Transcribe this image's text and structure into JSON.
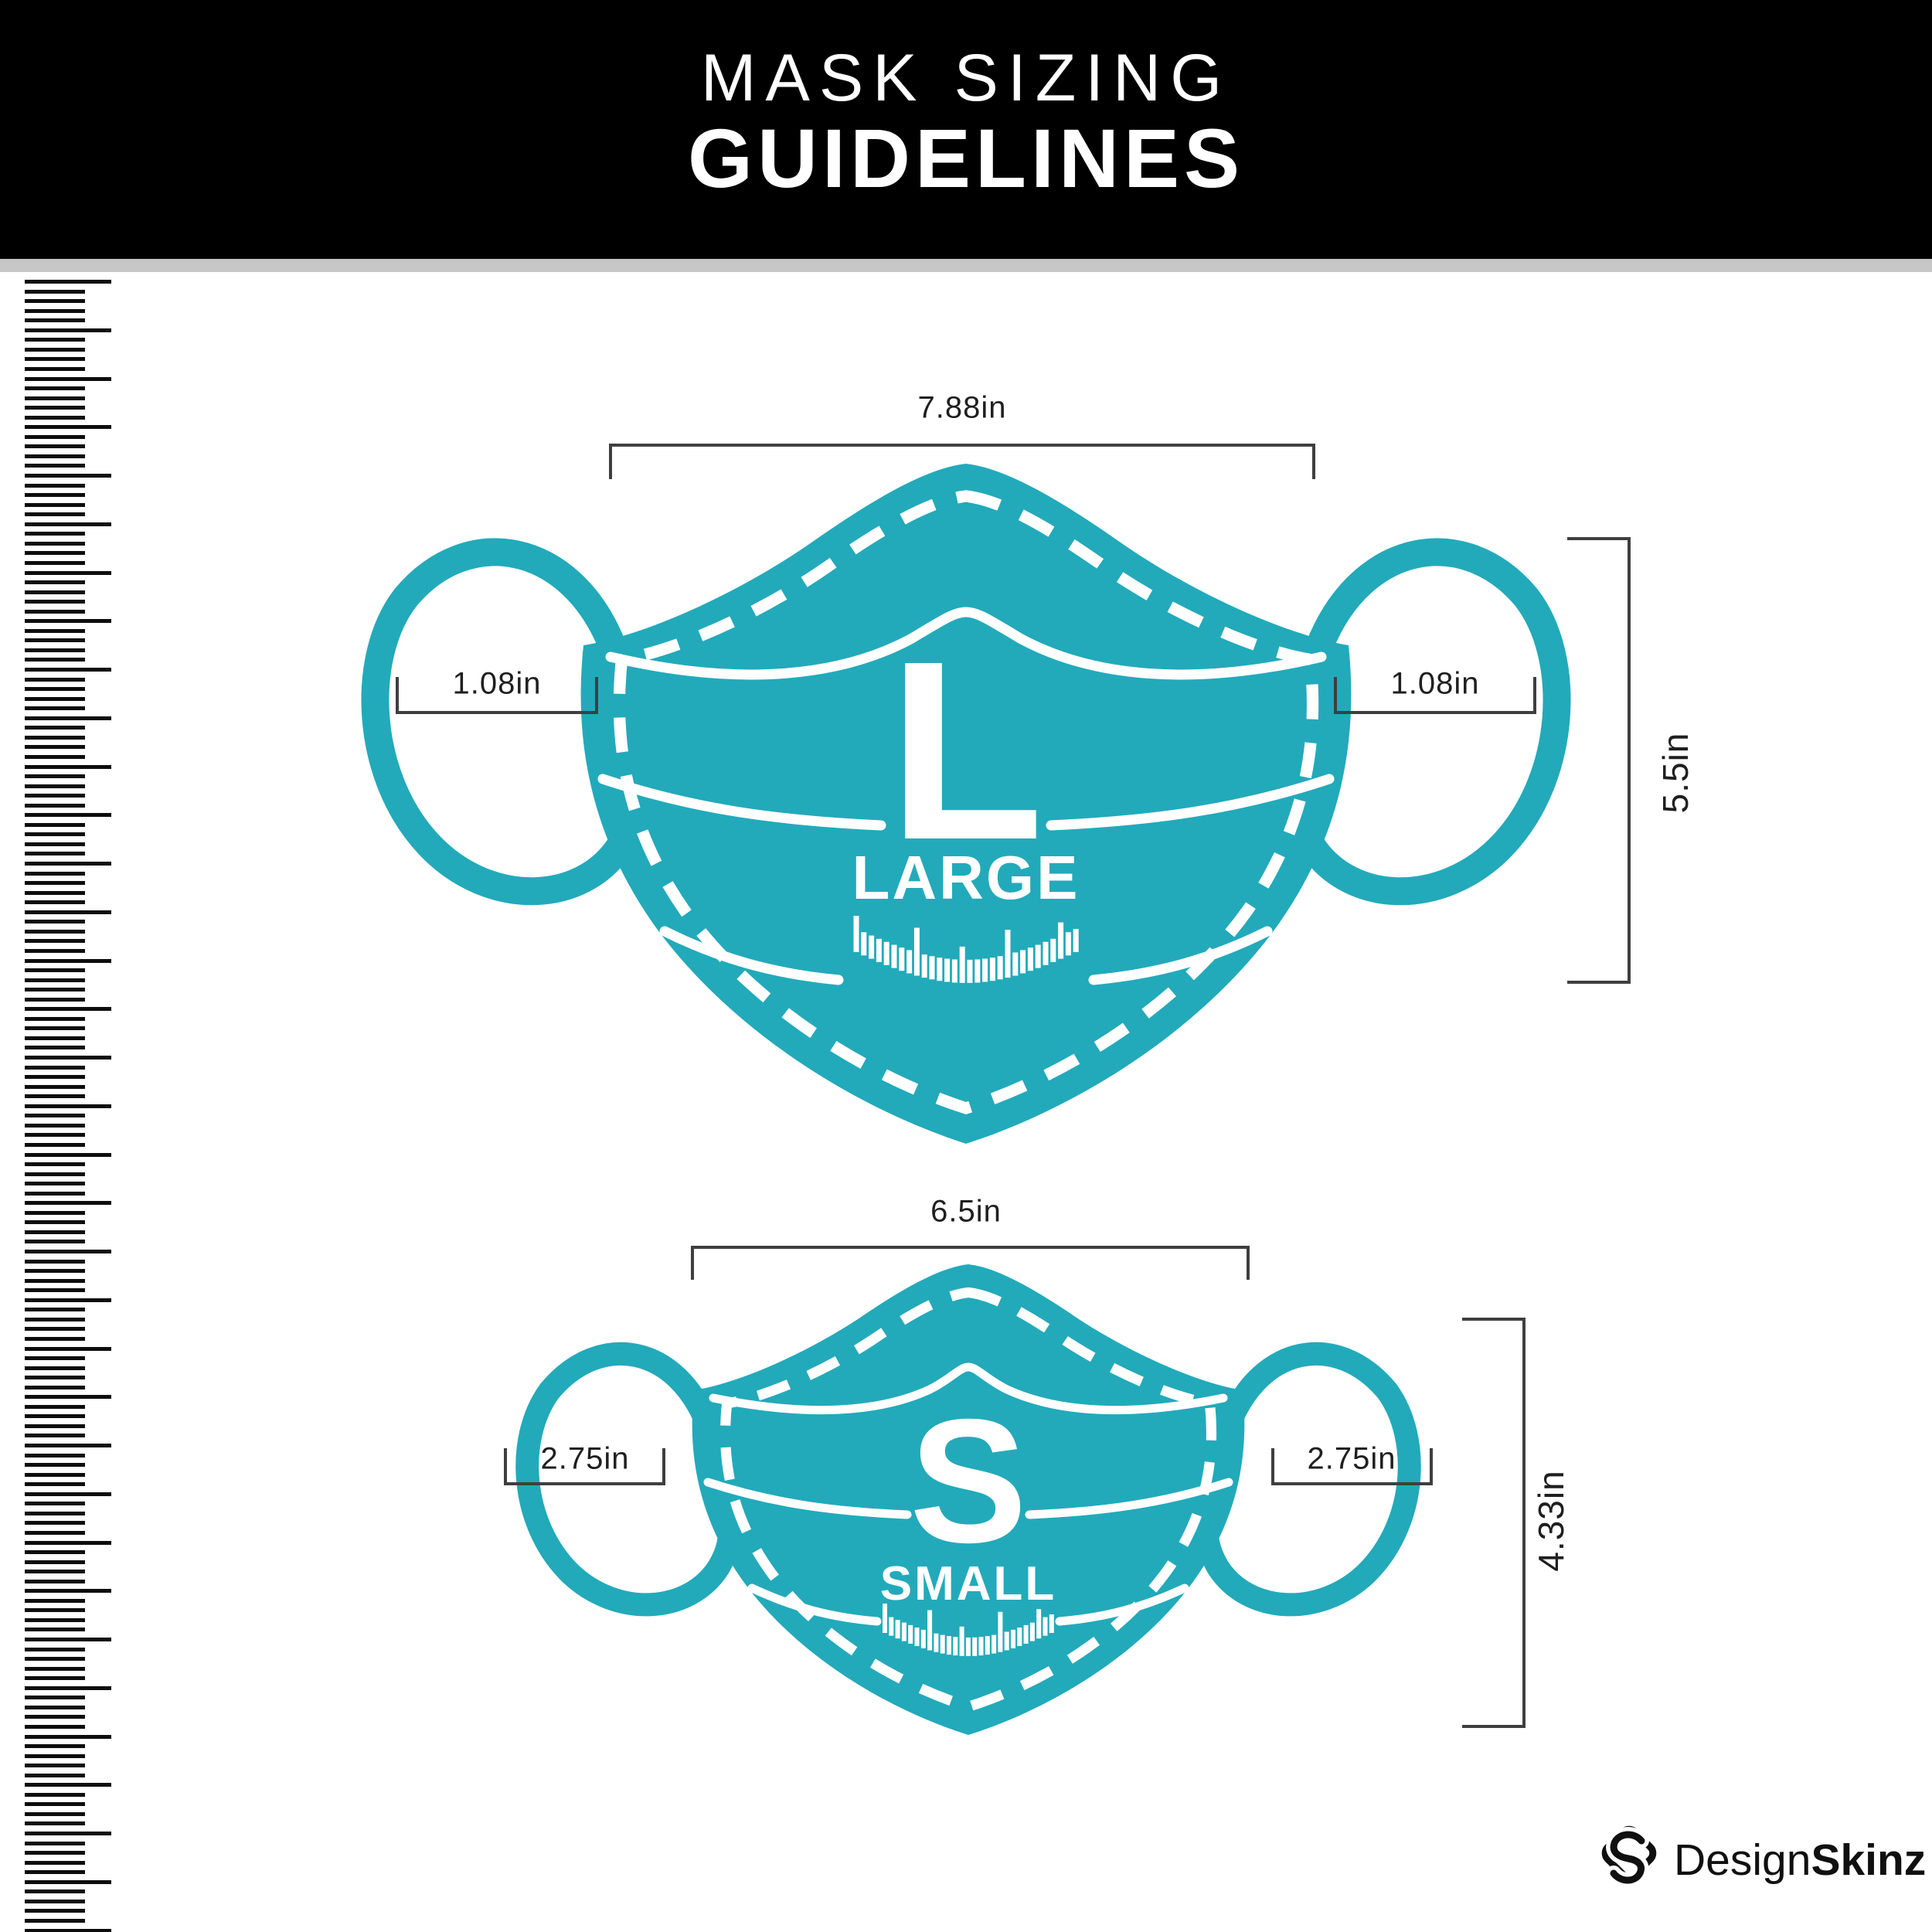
{
  "header": {
    "title_line1": "MASK SIZING",
    "title_line2": "GUIDELINES"
  },
  "colors": {
    "teal": "#22AABA",
    "header_bg": "#000000",
    "divider_gray": "#C6C6C6",
    "measure_line": "#3F3F3F",
    "label_text": "#1F1F1F"
  },
  "masks": {
    "large": {
      "letter": "L",
      "name": "LARGE",
      "width": "7.88in",
      "height": "5.5in",
      "ear_loop_width": "1.08in"
    },
    "small": {
      "letter": "S",
      "name": "SMALL",
      "width": "6.5in",
      "height": "4.33in",
      "ear_loop_width": "2.75in"
    }
  },
  "footer": {
    "brand_name_regular": "Design",
    "brand_name_bold": "Skinz"
  },
  "icons": {
    "ruler": "vertical-ruler-icon",
    "brand": "designskinz-diamond-s-icon",
    "chin_ticks": "measuring-scale-ticks"
  }
}
